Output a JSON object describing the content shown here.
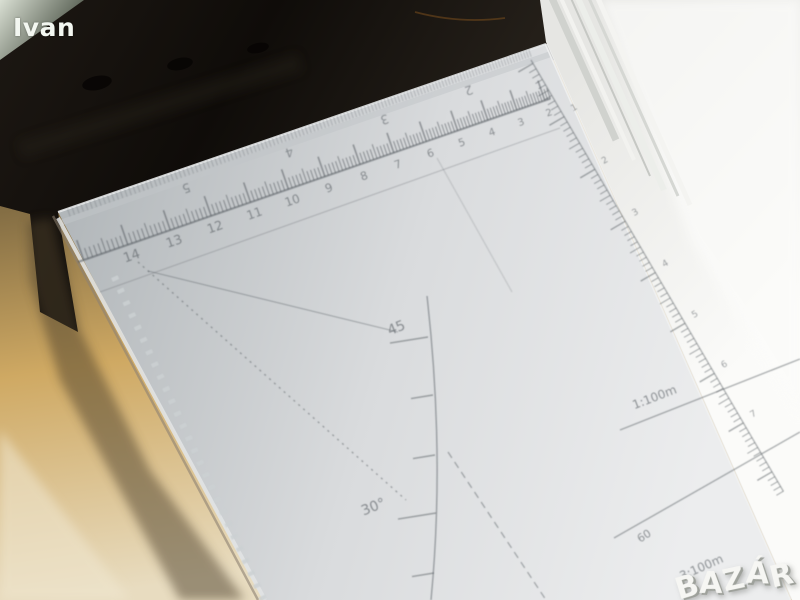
{
  "watermark": {
    "name": "Ivan",
    "color": "#f3f7f1"
  },
  "logo": {
    "text": "BAZÁR"
  },
  "ruler": {
    "cm_scale_numbers": [
      "14",
      "13",
      "12",
      "11",
      "10",
      "9",
      "8",
      "7",
      "6",
      "5",
      "4",
      "3",
      "2"
    ],
    "edge_scale_numbers": [
      "5",
      "4",
      "3",
      "2"
    ],
    "right_scale_numbers": [
      "1",
      "2",
      "3",
      "4",
      "5",
      "6",
      "7"
    ],
    "angle_labels": [
      "45",
      "30°"
    ],
    "reduction_scale_labels": [
      "1:100m",
      "60",
      "3:100m"
    ],
    "print_color": "#565c61",
    "body_color": "#d7dadc"
  },
  "background": {
    "desk_color": "#cda55e",
    "case_color": "#17130f",
    "paper_color": "#f2f2f0"
  }
}
